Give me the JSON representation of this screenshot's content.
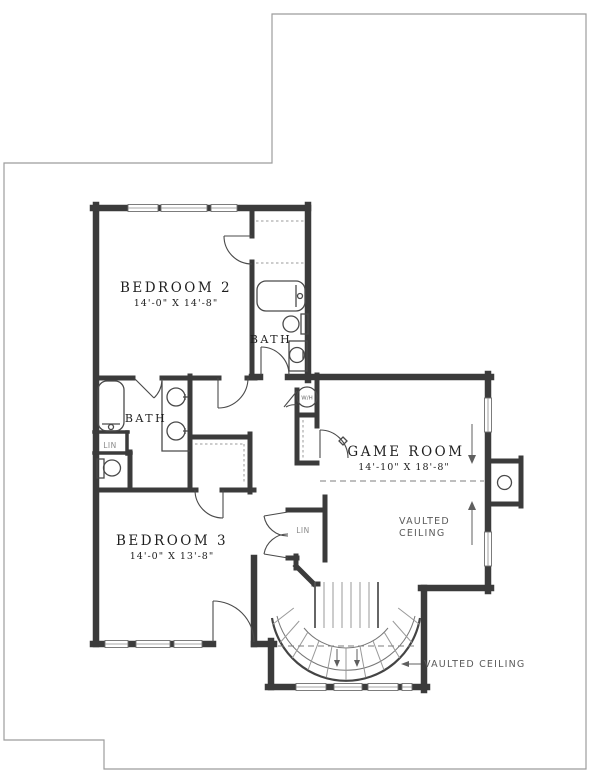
{
  "plan": {
    "bedroom2": {
      "name": "BEDROOM 2",
      "dims": "14'-0\" X 14'-8\""
    },
    "bedroom3": {
      "name": "BEDROOM 3",
      "dims": "14'-0\" X 13'-8\""
    },
    "game_room": {
      "name": "GAME ROOM",
      "dims": "14'-10\" X 18'-8\""
    },
    "bath_upper": "BATH",
    "bath_left": "BATH",
    "linen_bath": "LIN",
    "linen_hall": "LIN",
    "water_heater": "W/H",
    "vaulted_game_line1": "VAULTED",
    "vaulted_game_line2": "CEILING",
    "vaulted_stairs": "VAULTED CEILING"
  },
  "colors": {
    "wall": "#3b3b3b",
    "outline": "#9c9c9c",
    "fixture": "#4a4a4a",
    "label": "#1f1f1f",
    "note": "#5a5a5a",
    "bg": "#ffffff"
  }
}
